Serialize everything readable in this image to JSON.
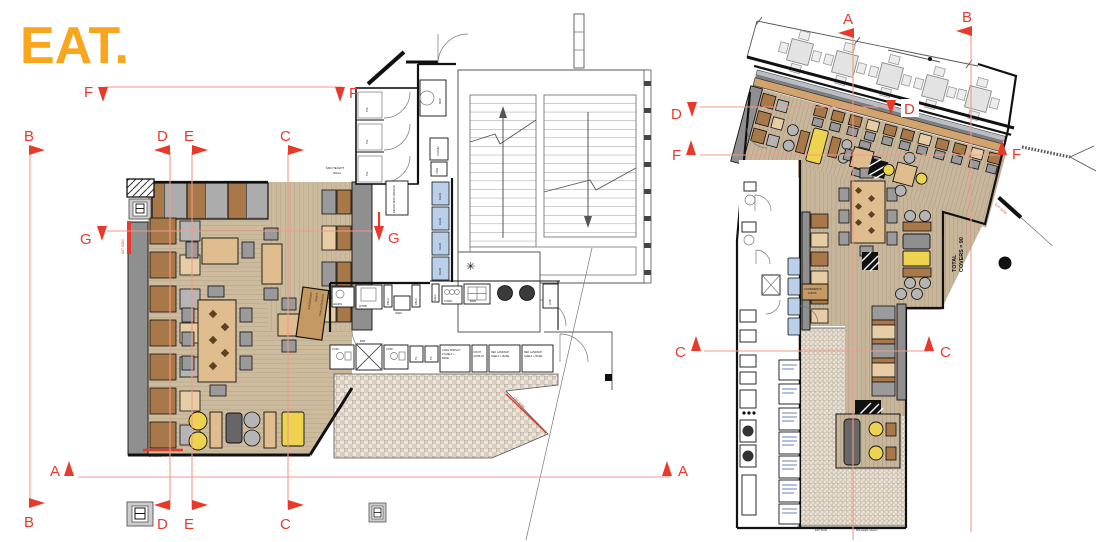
{
  "brand": {
    "logo": "EAT."
  },
  "sections": {
    "A": "A",
    "B": "B",
    "C": "C",
    "D": "D",
    "E": "E",
    "F": "F",
    "G": "G"
  },
  "left_plan": {
    "mid_height_wall": [
      "MID HEIGHT",
      "WALL"
    ],
    "bench_mirror": "BENCH WITH MIRROR",
    "rack": "RACK",
    "mop": "MOP",
    "coshh": "COSHH",
    "sink": "SINK",
    "wc": [
      "TF2",
      "TF1",
      "TF1"
    ],
    "hands": "HANDS",
    "wtrb": "WTRB",
    "fblo": "FBLO",
    "icem": "ICEM",
    "elec": "ELEC",
    "towd": "TOWD",
    "bain": "BAIN",
    "aob": "AOB",
    "coff": "COFF",
    "bfr": "BFR",
    "til": "TIL",
    "cake": [
      "CAKE DISPLAY",
      "3 SHELF +",
      "BASE"
    ],
    "fruit": [
      "FRUIT",
      "DISPLAY"
    ],
    "ref": [
      "REF LANDSCP",
      "SHELF + BASE"
    ],
    "condiments": [
      "CONDIMENTS",
      "& BINS",
      "MID HEIGHT WALL"
    ],
    "eat_sign": "EAT SIGN",
    "star": "✳"
  },
  "right_plan": {
    "total_covers": [
      "TOTAL",
      "COVERS = 90"
    ],
    "glazed_screen": "MID HEIGHT GLAZED SCREEN",
    "condiments": [
      "CONDIMENTS",
      "& BINS"
    ],
    "eat_sign": "EAT SIGN",
    "mid_height_screen": "Mid Height Screen"
  }
}
